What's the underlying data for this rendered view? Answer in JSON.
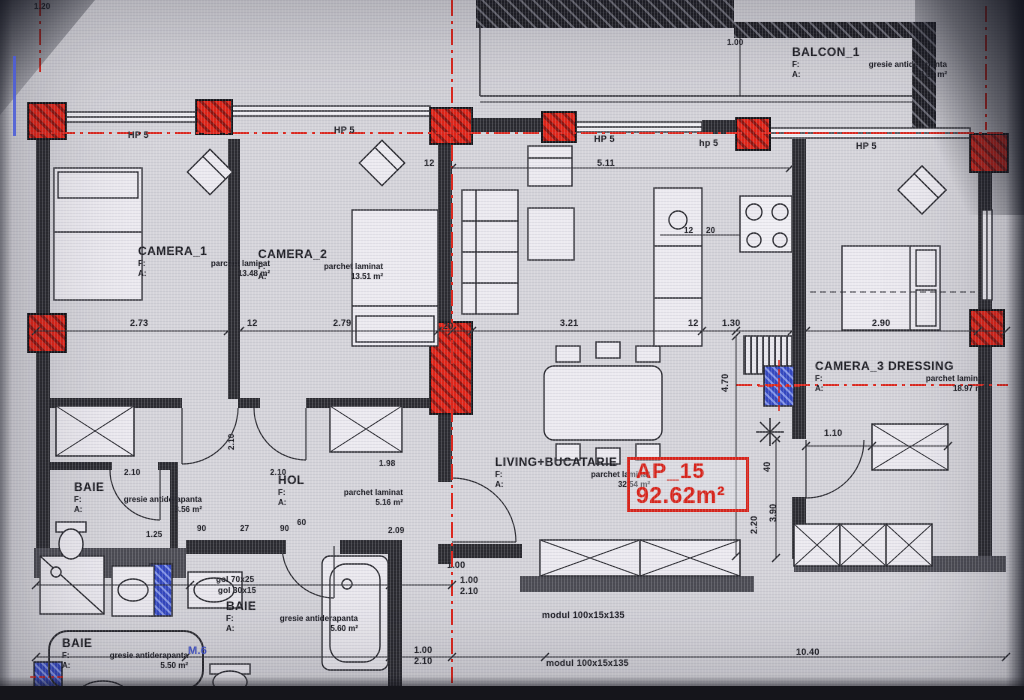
{
  "apartment": {
    "id": "AP_15",
    "area": "92.62m²"
  },
  "labels": {
    "f": "F:",
    "a": "A:"
  },
  "rooms": {
    "camera1": {
      "name": "CAMERA_1",
      "finish": "parchet laminat",
      "area": "13.48 m²"
    },
    "camera2": {
      "name": "CAMERA_2",
      "finish": "parchet laminat",
      "area": "13.51 m²"
    },
    "camera3": {
      "name": "CAMERA_3 DRESSING",
      "finish": "parchet laminat",
      "area": "18.97 m²"
    },
    "living": {
      "name": "LIVING+BUCATARIE",
      "finish": "parchet laminat",
      "area": "32.54 m²"
    },
    "hol": {
      "name": "HOL",
      "finish": "parchet laminat",
      "area": "5.16 m²"
    },
    "balcon1": {
      "name": "BALCON_1",
      "finish": "gresie antiderapanta",
      "area": "12.00 m²"
    },
    "baie1": {
      "name": "BAIE",
      "finish": "gresie antiderapanta",
      "area": "3.56 m²"
    },
    "baie2": {
      "name": "BAIE",
      "finish": "gresie antiderapanta",
      "area": "5.60 m²"
    },
    "baie3": {
      "name": "BAIE",
      "finish": "gresie antiderapanta",
      "area": "5.50 m²"
    }
  },
  "windows": {
    "w1": "HP 5",
    "w2": "HP 5",
    "w3": "HP 5",
    "w4": "hp 5",
    "w5": "HP 5"
  },
  "dims": {
    "a1": "5.11",
    "a2": "12",
    "c1": "2.73",
    "c2": "12",
    "c3": "2.79",
    "c4": "20",
    "c5": "3.21",
    "c6": "12",
    "c7": "1.30",
    "c8": "12",
    "c9": "2.90",
    "v1": "4.70",
    "v2": "40",
    "v3": "3.90",
    "v4": "2.20",
    "h1": "1.10",
    "b1": "1.00",
    "b2": "1.00",
    "b3": "2.10",
    "b4": "1.00",
    "b5": "2.10",
    "b6": "10.40",
    "d1": "2.10",
    "d2": "2.10",
    "d3": "90",
    "d4": "27",
    "d5": "90",
    "d6": "1.98",
    "d7": "2.09",
    "d8": "60",
    "d9": "1.25",
    "k1": "12",
    "k2": "20",
    "t1": "1.20",
    "t2": "1.00",
    "m1": "2.10"
  },
  "notes": {
    "gol1": "gol 70x25",
    "gol2": "gol 30x15",
    "module1": "modul 100x15x135",
    "module2": "modul 100x15x135",
    "m6": "M.6"
  },
  "colors": {
    "accent_red": "#e02317",
    "wall": "#2a2a30",
    "background": "#d5d4da",
    "blue": "#3246c0"
  }
}
